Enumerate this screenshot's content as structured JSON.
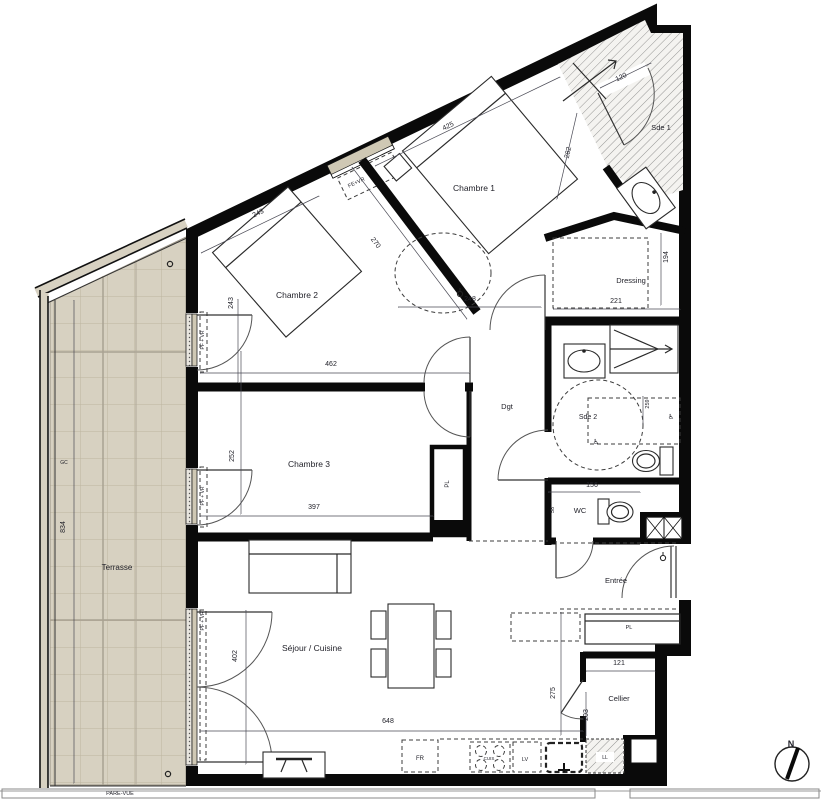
{
  "meta": {
    "drawing_type": "apartment floor plan",
    "wall_color": "#0a0a0a",
    "terrace_fill": "#d7d1c1",
    "terrace_grid_line": "#bcb5a0",
    "window_frame_fill": "#cfc8b4",
    "hatch_color": "#8a8a8a",
    "paper_color": "#ffffff"
  },
  "rooms": [
    {
      "label": "Chambre 1"
    },
    {
      "label": "Chambre 2"
    },
    {
      "label": "Chambre 3"
    },
    {
      "label": "Sde 1"
    },
    {
      "label": "Sde 2"
    },
    {
      "label": "Dressing"
    },
    {
      "label": "Dgt"
    },
    {
      "label": "WC"
    },
    {
      "label": "Entrée"
    },
    {
      "label": "Cellier"
    },
    {
      "label": "Séjour / Cuisine"
    },
    {
      "label": "Terrasse"
    }
  ],
  "dimensions_cm": [
    425,
    270,
    282,
    243,
    243,
    248,
    120,
    194,
    221,
    462,
    252,
    397,
    156,
    58,
    259,
    834,
    402,
    648,
    275,
    121,
    203
  ],
  "equipment_labels": [
    "FE+VR",
    "PF + VR",
    "PL",
    "FR",
    "LV",
    "LL",
    "CUIS",
    "GC",
    "PARE-VUE"
  ],
  "compass": {
    "label": "N"
  },
  "labels": [
    {
      "n": "room-label-chambre1",
      "t": "Chambre 1",
      "x": 474,
      "y": 191,
      "r": 0,
      "s": 8.5
    },
    {
      "n": "room-label-chambre2",
      "t": "Chambre 2",
      "x": 297,
      "y": 298,
      "r": 0,
      "s": 8.5
    },
    {
      "n": "room-label-chambre3",
      "t": "Chambre 3",
      "x": 309,
      "y": 467,
      "r": 0,
      "s": 8.5
    },
    {
      "n": "room-label-sde1",
      "t": "Sde 1",
      "x": 661,
      "y": 130,
      "r": 0,
      "s": 7.5
    },
    {
      "n": "room-label-sde2",
      "t": "Sde 2",
      "x": 588,
      "y": 419,
      "r": 0,
      "s": 7
    },
    {
      "n": "room-label-dressing",
      "t": "Dressing",
      "x": 631,
      "y": 283,
      "r": 0,
      "s": 7.5
    },
    {
      "n": "room-label-dgt",
      "t": "Dgt",
      "x": 507,
      "y": 409,
      "r": 0,
      "s": 7.5
    },
    {
      "n": "room-label-wc",
      "t": "WC",
      "x": 580,
      "y": 513,
      "r": 0,
      "s": 7.5
    },
    {
      "n": "room-label-entree",
      "t": "Entrée",
      "x": 616,
      "y": 583,
      "r": 0,
      "s": 7.5
    },
    {
      "n": "room-label-cellier",
      "t": "Cellier",
      "x": 619,
      "y": 701,
      "r": 0,
      "s": 7.5
    },
    {
      "n": "room-label-sejour",
      "t": "Séjour / Cuisine",
      "x": 312,
      "y": 651,
      "r": 0,
      "s": 8.5
    },
    {
      "n": "room-label-terrasse",
      "t": "Terrasse",
      "x": 117,
      "y": 570,
      "r": 0,
      "s": 8
    },
    {
      "n": "dim-425",
      "t": "425",
      "x": 449,
      "y": 128,
      "r": -25.3,
      "s": 7
    },
    {
      "n": "dim-270",
      "t": "270",
      "x": 374,
      "y": 244,
      "r": 52.9,
      "s": 7
    },
    {
      "n": "dim-282",
      "t": "282",
      "x": 570,
      "y": 153,
      "r": -77,
      "s": 7
    },
    {
      "n": "dim-243-diag",
      "t": "243",
      "x": 259,
      "y": 215,
      "r": -26,
      "s": 7
    },
    {
      "n": "dim-243-vert",
      "t": "243",
      "x": 233,
      "y": 303,
      "r": -90,
      "s": 7
    },
    {
      "n": "dim-248",
      "t": "248",
      "x": 470,
      "y": 301,
      "r": 0,
      "s": 7
    },
    {
      "n": "dim-120",
      "t": "120",
      "x": 622,
      "y": 79,
      "r": -26,
      "s": 7
    },
    {
      "n": "dim-194",
      "t": "194",
      "x": 668,
      "y": 257,
      "r": -90,
      "s": 7
    },
    {
      "n": "dim-221",
      "t": "221",
      "x": 616,
      "y": 303,
      "r": 0,
      "s": 7
    },
    {
      "n": "dim-462",
      "t": "462",
      "x": 331,
      "y": 366,
      "r": 0,
      "s": 7
    },
    {
      "n": "dim-252",
      "t": "252",
      "x": 234,
      "y": 456,
      "r": -90,
      "s": 7
    },
    {
      "n": "dim-397",
      "t": "397",
      "x": 314,
      "y": 509,
      "r": 0,
      "s": 7
    },
    {
      "n": "dim-156",
      "t": "156",
      "x": 592,
      "y": 487,
      "r": 0,
      "s": 7
    },
    {
      "n": "dim-58",
      "t": "58",
      "x": 554,
      "y": 510,
      "r": -90,
      "s": 5.5
    },
    {
      "n": "dim-259",
      "t": "259",
      "x": 649,
      "y": 404,
      "r": -90,
      "s": 5.5
    },
    {
      "n": "dim-834",
      "t": "834",
      "x": 65,
      "y": 527,
      "r": -90,
      "s": 7
    },
    {
      "n": "dim-402",
      "t": "402",
      "x": 237,
      "y": 656,
      "r": -90,
      "s": 7
    },
    {
      "n": "dim-648",
      "t": "648",
      "x": 388,
      "y": 723,
      "r": 0,
      "s": 7
    },
    {
      "n": "dim-275",
      "t": "275",
      "x": 555,
      "y": 693,
      "r": -90,
      "s": 7
    },
    {
      "n": "dim-121",
      "t": "121",
      "x": 619,
      "y": 665,
      "r": 0,
      "s": 7
    },
    {
      "n": "dim-203",
      "t": "203",
      "x": 588,
      "y": 715,
      "r": -90,
      "s": 7
    },
    {
      "n": "window-label-fevr",
      "t": "FE+VR",
      "x": 357,
      "y": 184,
      "r": -25.3,
      "s": 5.5
    },
    {
      "n": "window-label-pfvr-1",
      "t": "PF + VR",
      "x": 204,
      "y": 340,
      "r": -90,
      "s": 5
    },
    {
      "n": "window-label-pfvr-2",
      "t": "PF + VR",
      "x": 204,
      "y": 496,
      "r": -90,
      "s": 5
    },
    {
      "n": "window-label-pfvr-3",
      "t": "PF + VR",
      "x": 204,
      "y": 621,
      "r": -90,
      "s": 5
    },
    {
      "n": "closet-label-pl-corridor",
      "t": "PL",
      "x": 449,
      "y": 484,
      "r": -90,
      "s": 6
    },
    {
      "n": "closet-label-pl-entree",
      "t": "PL",
      "x": 629,
      "y": 629,
      "r": 0,
      "s": 5.5
    },
    {
      "n": "kitchen-label-fr",
      "t": "FR",
      "x": 420,
      "y": 760,
      "r": 0,
      "s": 6
    },
    {
      "n": "kitchen-label-lv",
      "t": "LV",
      "x": 525,
      "y": 761,
      "r": 0,
      "s": 5.5
    },
    {
      "n": "kitchen-label-cuis",
      "t": "CUIS",
      "x": 489,
      "y": 760,
      "r": 0,
      "s": 4.5
    },
    {
      "n": "cellier-label-ll",
      "t": "LL",
      "x": 605,
      "y": 759,
      "r": 0,
      "s": 5
    },
    {
      "n": "terrace-label-gc",
      "t": "GC",
      "x": 64,
      "y": 464,
      "r": 0,
      "s": 5
    },
    {
      "n": "terrace-label-parevue",
      "t": "PARE-VUE",
      "x": 120,
      "y": 795,
      "r": 0,
      "s": 5.5
    },
    {
      "n": "compass-label-n",
      "t": "N",
      "x": 791,
      "y": 747,
      "r": 0,
      "s": 9,
      "b": 1
    },
    {
      "n": "accessibility-icon",
      "t": "♿",
      "x": 596,
      "y": 444,
      "r": 0,
      "s": 7
    },
    {
      "n": "accessibility-icon",
      "t": "♿",
      "x": 671,
      "y": 419,
      "r": 0,
      "s": 7
    }
  ]
}
